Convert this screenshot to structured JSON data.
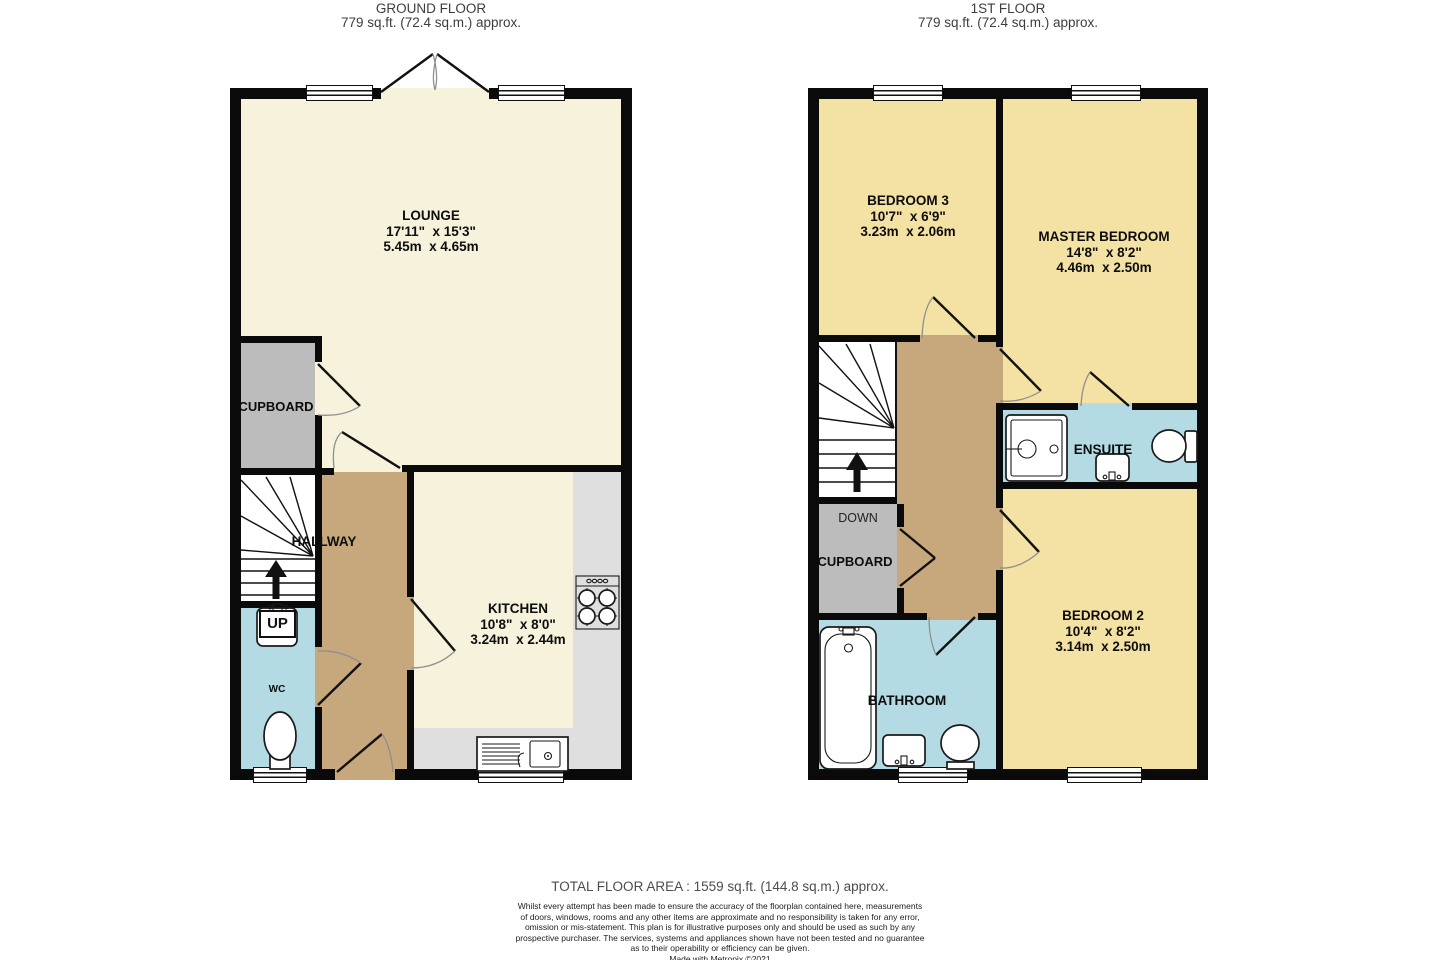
{
  "ground_floor": {
    "title": "GROUND FLOOR",
    "area": "779 sq.ft. (72.4 sq.m.) approx.",
    "rooms": {
      "lounge": {
        "name": "LOUNGE",
        "imperial": "17'11\"  x 15'3\"",
        "metric": "5.45m  x 4.65m"
      },
      "kitchen": {
        "name": "KITCHEN",
        "imperial": "10'8\"  x 8'0\"",
        "metric": "3.24m  x 2.44m"
      },
      "cupboard": {
        "name": "CUPBOARD"
      },
      "hallway": {
        "name": "HALLWAY"
      },
      "wc": {
        "name": "WC"
      },
      "stairs": {
        "direction": "UP"
      }
    }
  },
  "first_floor": {
    "title": "1ST FLOOR",
    "area": "779 sq.ft. (72.4 sq.m.) approx.",
    "rooms": {
      "bedroom3": {
        "name": "BEDROOM 3",
        "imperial": "10'7\"  x 6'9\"",
        "metric": "3.23m  x 2.06m"
      },
      "master_bedroom": {
        "name": "MASTER BEDROOM",
        "imperial": "14'8\"  x 8'2\"",
        "metric": "4.46m  x 2.50m"
      },
      "bedroom2": {
        "name": "BEDROOM 2",
        "imperial": "10'4\"  x 8'2\"",
        "metric": "3.14m  x 2.50m"
      },
      "ensuite": {
        "name": "ENSUITE"
      },
      "bathroom": {
        "name": "BATHROOM"
      },
      "cupboard": {
        "name": "CUPBOARD"
      },
      "stairs": {
        "direction": "DOWN"
      }
    }
  },
  "footer": {
    "total": "TOTAL FLOOR AREA : 1559 sq.ft. (144.8 sq.m.) approx.",
    "disclaimer_lines": [
      "Whilst every attempt has been made to ensure the accuracy of the floorplan contained here, measurements",
      "of doors, windows, rooms and any other items are approximate and no responsibility is taken for any error,",
      "omission or mis-statement. This plan is for illustrative purposes only and should be used as such by any",
      "prospective purchaser. The services, systems and appliances shown have not been tested and no guarantee",
      "as to their operability or efficiency can be given."
    ],
    "credit": "Made with Metropix ©2021"
  },
  "colors": {
    "wall": "#0a0a0a",
    "lounge_kitchen_floor": "#f7f2dc",
    "bedroom_floor": "#f4e1a4",
    "wet_room_floor": "#b4dbe3",
    "hallway_floor": "#c7a77c",
    "cupboard_floor": "#bcbcbc",
    "kitchen_counter": "#dfdfdf"
  }
}
